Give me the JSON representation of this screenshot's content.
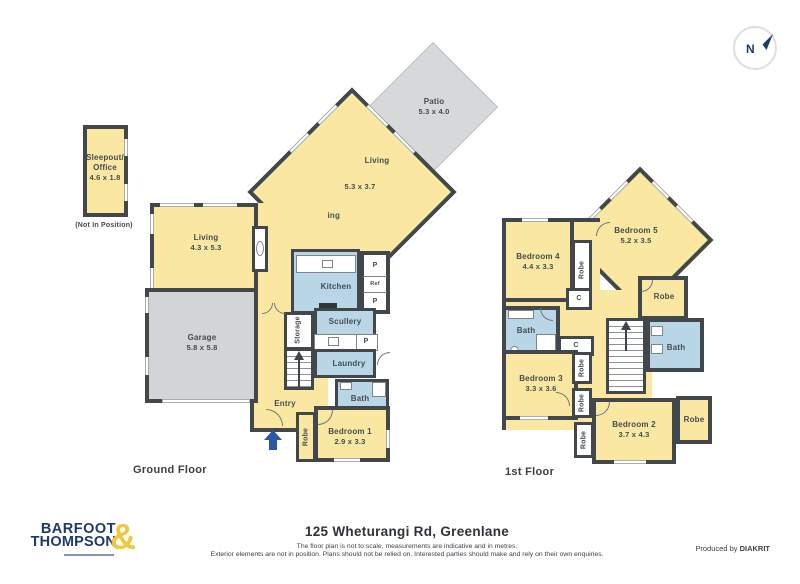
{
  "north_label": "N",
  "sleepout": {
    "name_line1": "Sleepout/",
    "name_line2": "Office",
    "dims": "4.6 x 1.8",
    "note": "(Not In Position)"
  },
  "ground": {
    "floor_label": "Ground Floor",
    "patio_name": "Patio",
    "patio_dims": "5.3 x 4.0",
    "living2_name": "Living",
    "living2_dims": "5.3 x 3.7",
    "dining_name": "Dining",
    "living_name": "Living",
    "living_dims": "4.3 x 5.3",
    "kitchen_name": "Kitchen",
    "scullery_name": "Scullery",
    "laundry_name": "Laundry",
    "bath_name": "Bath",
    "garage_name": "Garage",
    "garage_dims": "5.8 x 5.8",
    "entry_name": "Entry",
    "bed1_name": "Bedroom 1",
    "bed1_dims": "2.9 x 3.3",
    "robe_label": "Robe",
    "storage_label": "Storage",
    "pantry_label": "P",
    "fridge_label": "Ref"
  },
  "first": {
    "floor_label": "1st Floor",
    "bed5_name": "Bedroom 5",
    "bed5_dims": "5.2 x 3.5",
    "bed4_name": "Bedroom 4",
    "bed4_dims": "4.4 x 3.3",
    "bed3_name": "Bedroom 3",
    "bed3_dims": "3.3 x 3.6",
    "bed2_name": "Bedroom 2",
    "bed2_dims": "3.7 x 4.3",
    "bath_label": "Bath",
    "robe_label": "Robe",
    "cupboard_label": "C"
  },
  "footer": {
    "logo_line1": "BARFOOT",
    "logo_line2": "THOMPSON",
    "logo_ampersand": "&",
    "title": "125 Wheturangi Rd, Greenlane",
    "disclaimer1": "The floor plan is not to scale, measurements are indicative and in metres.",
    "disclaimer2": "Exterior elements are not in position. Plans should not be relied on. Interested parties should make and rely on their own enquiries.",
    "produced_by": "Produced by ",
    "producer": "DIAKRIT"
  },
  "colors": {
    "wall": "#42474C",
    "room_yellow": "#FAE8A2",
    "wet_area_blue": "#B9D6E7",
    "garage_gray": "#D2D4D6",
    "brand_navy": "#1E3A66",
    "brand_yellow": "#F1C73E",
    "entry_arrow_blue": "#2B57A7"
  }
}
